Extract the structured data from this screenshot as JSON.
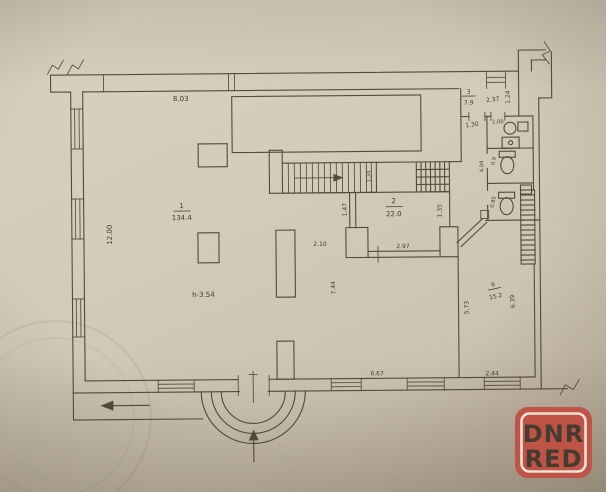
{
  "colors": {
    "paper": "#d4cbbc",
    "ink": "#4e4437",
    "watermark_bg": "#bf5347",
    "watermark_fg": "#ece3d4"
  },
  "watermark": {
    "line1": "DNR",
    "line2": "RED"
  },
  "plan": {
    "rooms": [
      {
        "number": "1",
        "area": "134.4"
      },
      {
        "number": "2",
        "area": "22.0"
      },
      {
        "number": "3",
        "area": "7.9"
      },
      {
        "number": "6",
        "area": "15.2"
      }
    ],
    "height_note": "h-3.54",
    "dims": {
      "top_width": "8.03",
      "left_height": "12.00",
      "room3_width": "2.37",
      "room3_side": "1.24",
      "room3_door": "1.30",
      "san_top": "1.00",
      "san_side": "4.04",
      "san_upper": "0.9",
      "san_lower": "0.85",
      "stairs_side": "1.34",
      "landing": "1.47",
      "corridor": "2.10",
      "room2_side": "1.35",
      "room2_opening": "2.97",
      "hall_depth": "7.44",
      "room6_left": "5.73",
      "room6_right": "6.39",
      "bottom_main": "6.67",
      "bottom_right": "2.44"
    }
  }
}
